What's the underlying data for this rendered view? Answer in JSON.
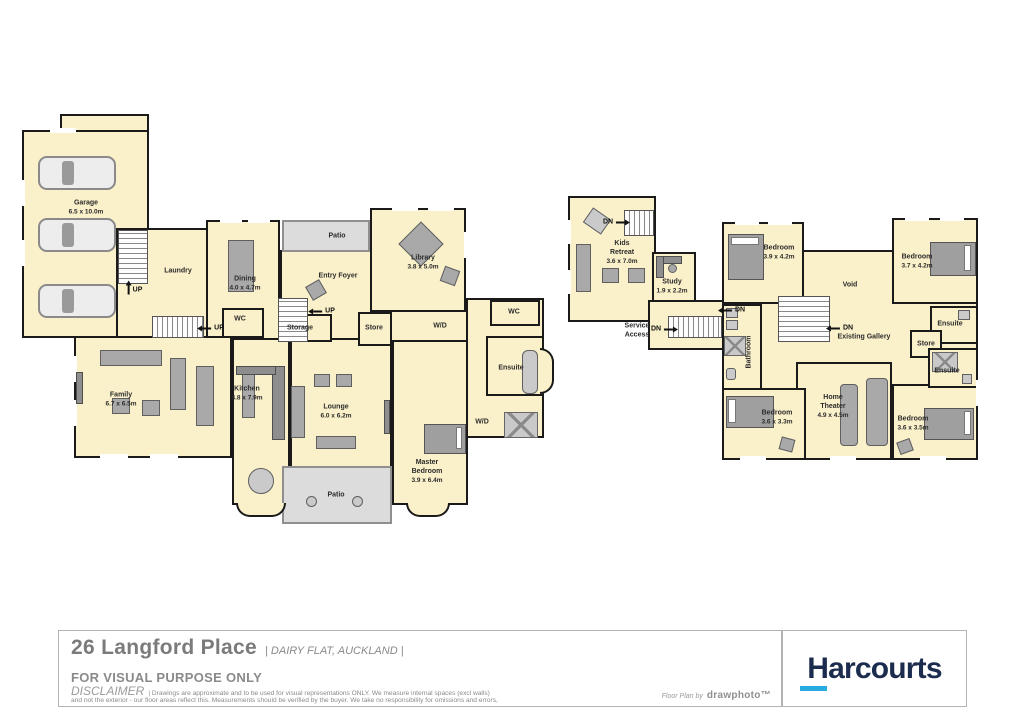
{
  "colors": {
    "floor_fill": "#FAF0CA",
    "patio_fill": "#DCDCDC",
    "wall": "#1A1A1A",
    "furniture": "#A9A9A9",
    "harcourts_navy": "#1B2C4E",
    "harcourts_cyan": "#29ABE2"
  },
  "labels": {
    "up": "UP",
    "dn": "DN"
  },
  "ground_floor": {
    "rooms": {
      "garage": {
        "name": "Garage",
        "dims": "6.5 x 10.0m"
      },
      "laundry": {
        "name": "Laundry"
      },
      "dining": {
        "name": "Dining",
        "dims": "4.0 x 4.7m"
      },
      "patio_top": {
        "name": "Patio"
      },
      "entry_foyer": {
        "name": "Entry Foyer"
      },
      "library": {
        "name": "Library",
        "dims": "3.8 x 5.0m"
      },
      "wc_mid": {
        "name": "WC"
      },
      "storage": {
        "name": "Storage"
      },
      "store": {
        "name": "Store"
      },
      "wd_hall": {
        "name": "W/D"
      },
      "wc_right": {
        "name": "WC"
      },
      "ensuite": {
        "name": "Ensuite"
      },
      "family": {
        "name": "Family",
        "dims": "6.7 x 6.5m"
      },
      "kitchen": {
        "name": "Kitchen",
        "dims": "4.8 x 7.9m"
      },
      "lounge": {
        "name": "Lounge",
        "dims": "6.0 x 6.2m"
      },
      "master_bedroom": {
        "name": "Master Bedroom",
        "dims": "3.9 x 6.4m"
      },
      "wd_master": {
        "name": "W/D"
      },
      "patio_bottom": {
        "name": "Patio"
      }
    }
  },
  "upper_floor": {
    "rooms": {
      "kids_retreat": {
        "name": "Kids Retreat",
        "dims": "3.6 x 7.0m"
      },
      "study": {
        "name": "Study",
        "dims": "1.9 x 2.2m"
      },
      "service_access": {
        "name": "Service Access"
      },
      "bedroom_nw": {
        "name": "Bedroom",
        "dims": "3.9 x 4.2m"
      },
      "void": {
        "name": "Void"
      },
      "bedroom_ne": {
        "name": "Bedroom",
        "dims": "3.7 x 4.2m"
      },
      "existing_gallery": {
        "name": "Existing Gallery"
      },
      "bathroom": {
        "name": "Bathroom"
      },
      "ensuite_east": {
        "name": "Ensuite"
      },
      "store": {
        "name": "Store"
      },
      "ensuite_south": {
        "name": "Ensuite"
      },
      "bedroom_sw": {
        "name": "Bedroom",
        "dims": "3.6 x 3.3m"
      },
      "home_theater": {
        "name": "Home Theater",
        "dims": "4.9 x 4.5m"
      },
      "bedroom_se": {
        "name": "Bedroom",
        "dims": "3.6 x 3.5m"
      }
    }
  },
  "footer": {
    "address": "26 Langford Place",
    "location": "| DAIRY FLAT, AUCKLAND |",
    "purpose": "FOR VISUAL PURPOSE ONLY",
    "disclaimer_label": "DISCLAIMER",
    "disclaimer_line1": "| Drawings are approximate and to be used for visual representations ONLY. We measure internal spaces (excl walls)",
    "disclaimer_line2": "and not the exterior - our floor areas reflect this. Measurements should be verified by the buyer. We take no responsibility for omissions and errors,",
    "credit_prefix": "Floor Plan by",
    "credit_brand": "drawphoto™",
    "brand": "Harcourts"
  }
}
